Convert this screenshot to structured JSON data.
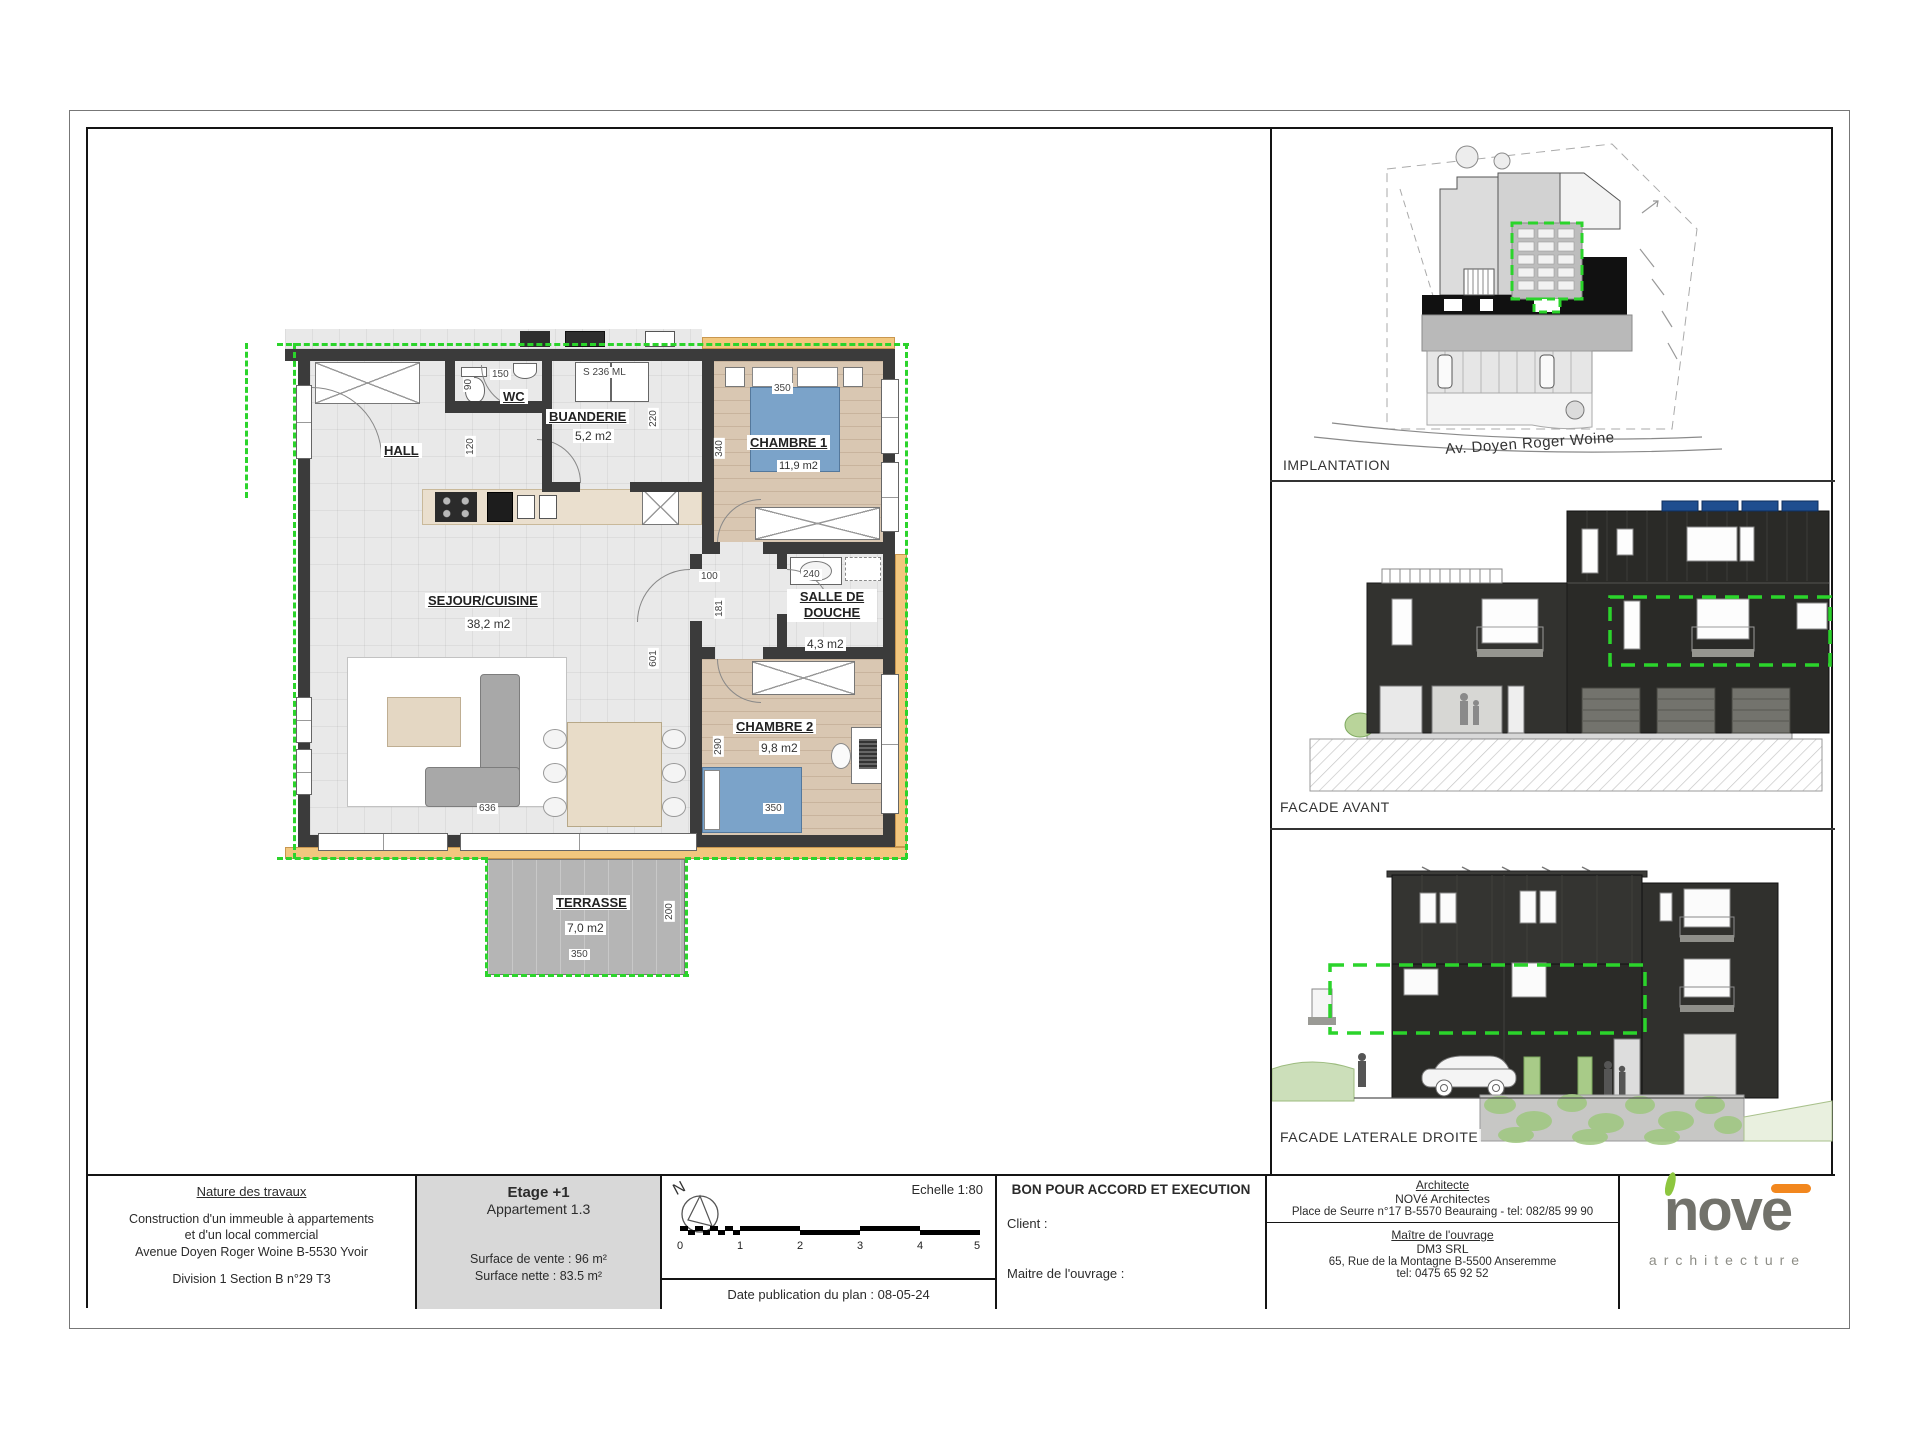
{
  "sheet": {
    "north_label": "N"
  },
  "floor_plan": {
    "rooms": [
      {
        "name": "HALL",
        "area": ""
      },
      {
        "name": "WC",
        "area": ""
      },
      {
        "name": "BUANDERIE",
        "area": "5,2 m2"
      },
      {
        "name": "CHAMBRE 1",
        "area": "11,9 m2"
      },
      {
        "name": "SEJOUR/CUISINE",
        "area": "38,2 m2"
      },
      {
        "name": "SALLE DE DOUCHE",
        "area": "4,3 m2"
      },
      {
        "name": "CHAMBRE 2",
        "area": "9,8 m2"
      },
      {
        "name": "TERRASSE",
        "area": "7,0 m2"
      }
    ],
    "dims": [
      "150",
      "90",
      "120",
      "S 236 ML",
      "220",
      "350",
      "340",
      "100",
      "181",
      "240",
      "601",
      "290",
      "636",
      "350",
      "200",
      "350"
    ]
  },
  "panels": [
    {
      "label": "IMPLANTATION",
      "street": "Av. Doyen Roger Woine"
    },
    {
      "label": "FACADE AVANT"
    },
    {
      "label": "FACADE LATERALE DROITE"
    }
  ],
  "title_block": {
    "nature": {
      "title": "Nature des travaux",
      "lines": [
        "Construction d'un immeuble à appartements",
        "et d'un local commercial",
        "Avenue Doyen Roger Woine B-5530 Yvoir"
      ],
      "ref": "Division 1 Section B n°29 T3"
    },
    "etage": {
      "title": "Etage +1",
      "apartment": "Appartement 1.3",
      "surface_vente": "Surface de vente : 96 m²",
      "surface_nette": "Surface nette : 83.5 m²"
    },
    "scale": {
      "echelle": "Echelle 1:80",
      "ticks": [
        "0",
        "1",
        "2",
        "3",
        "4",
        "5"
      ],
      "date": "Date publication du plan : 08-05-24"
    },
    "approval": {
      "title": "BON POUR ACCORD ET EXECUTION",
      "client": "Client :",
      "maitre": "Maitre de l'ouvrage :"
    },
    "architect": {
      "title": "Architecte",
      "name": "NOVé Architectes",
      "address": "Place de Seurre n°17 B-5570 Beauraing - tel: 082/85 99 90",
      "owner_title": "Maître de l'ouvrage",
      "owner_name": "DM3 SRL",
      "owner_address": "65, Rue de la Montagne B-5500 Anseremme",
      "owner_tel": "tel: 0475 65 92 52"
    },
    "logo": {
      "word": "nove",
      "sub": "architecture"
    }
  }
}
